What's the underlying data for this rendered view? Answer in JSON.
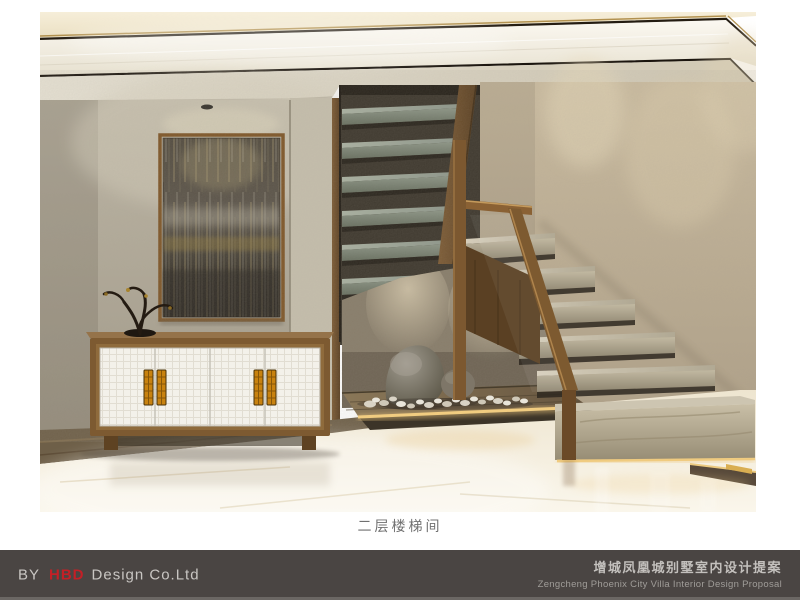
{
  "page": {
    "background": "#ffffff"
  },
  "image": {
    "caption": "二层楼梯间"
  },
  "footer": {
    "background": "#4a4543",
    "left": {
      "by": "BY",
      "brand": "HBD",
      "company": "Design Co.Ltd",
      "brand_color": "#c41f26",
      "text_color": "#c9c6c3"
    },
    "right": {
      "title_zh": "增城凤凰城别墅室内设计提案",
      "title_en": "Zengcheng Phoenix City Villa Interior Design Proposal",
      "zh_color": "#c3c0bd",
      "en_color": "#a09d99"
    }
  },
  "palette": {
    "ceiling_cream": "#f0e8d1",
    "gold_trim": "#a8854a",
    "dark_trim": "#211a12",
    "left_wall": "#b4ad9c",
    "right_wall": "#c2b299",
    "understair_wall": "#877c69",
    "opening_shadow": "#3b352b",
    "wood": "#7c5830",
    "marble_tread": "#bdb49e",
    "upper_tread": "#96a093",
    "floor": "#f3ecdb",
    "led_glow": "#eec87f",
    "cabinet_door": "#f4f2ec",
    "handle_amber": "#c8820f",
    "art_dark": "#46403a"
  }
}
